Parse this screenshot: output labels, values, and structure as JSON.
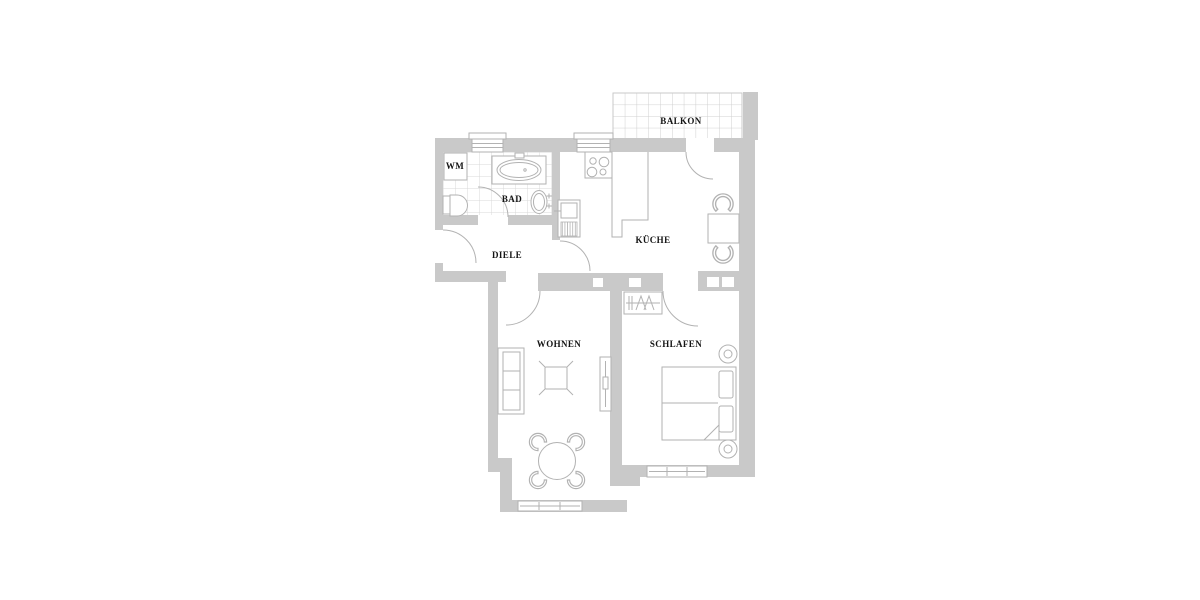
{
  "colors": {
    "wall": "#c9c9c9",
    "line": "#b2b2b2",
    "tile": "#d9d9d9",
    "grid": "#cfcfcf",
    "text": "#141414",
    "background": "#ffffff"
  },
  "rooms": {
    "balkon": {
      "label": "BALKON"
    },
    "wm": {
      "label": "WM"
    },
    "bad": {
      "label": "BAD"
    },
    "diele": {
      "label": "DIELE"
    },
    "kueche": {
      "label": "KÜCHE"
    },
    "wohnen": {
      "label": "WOHNEN"
    },
    "schlafen": {
      "label": "SCHLAFEN"
    }
  },
  "fixtures": [
    "bathtub-icon",
    "washbasin-icon",
    "toilet-icon",
    "washing-machine-icon",
    "stove-icon",
    "kitchen-sink-icon",
    "kitchen-counter-icon",
    "kitchen-table-icon",
    "chair-icon",
    "sofa-icon",
    "coffee-table-icon",
    "radiator-icon",
    "dining-table-icon",
    "double-bed-icon",
    "nightstand-icon",
    "wardrobe-icon",
    "window-icon",
    "door-swing-icon",
    "balcony-tiles-icon"
  ]
}
